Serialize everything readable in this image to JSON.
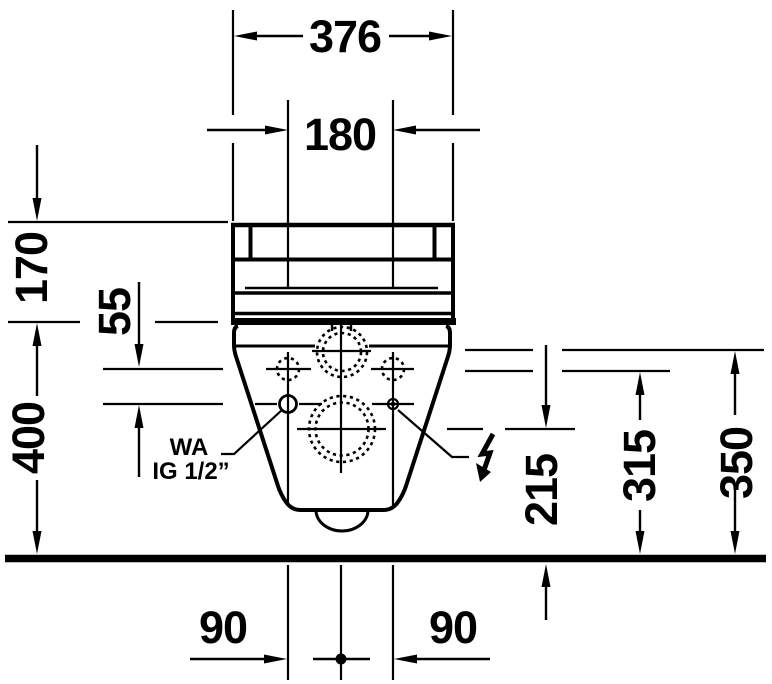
{
  "drawing": {
    "description": "wall-hung toilet rear elevation technical dimension drawing",
    "colors": {
      "ink": "#000000",
      "paper": "#ffffff"
    },
    "dimensions": {
      "overall_width": "376",
      "fixing_spacing": "180",
      "tank_height": "170",
      "body_height": "400",
      "connection_offset": "55",
      "outlet_center_height": "215",
      "fixing_hole_height": "315",
      "water_supply_height": "350",
      "bottom_left_offset": "90",
      "bottom_right_offset": "90"
    },
    "annotations": {
      "water_abbr": "WA",
      "water_thread": "IG 1/2”"
    }
  }
}
